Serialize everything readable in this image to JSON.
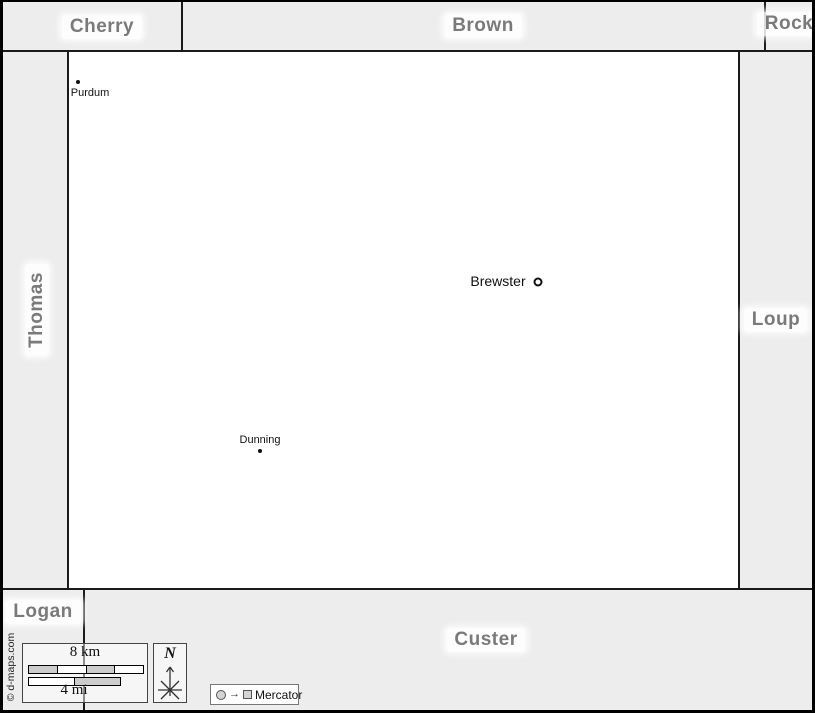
{
  "regions": {
    "cherry": "Cherry",
    "brown": "Brown",
    "rock": "Rock",
    "thomas": "Thomas",
    "loup": "Loup",
    "logan": "Logan",
    "custer": "Custer"
  },
  "towns": [
    {
      "name": "Purdum",
      "marker": "dot"
    },
    {
      "name": "Brewster",
      "marker": "county-seat-ring"
    },
    {
      "name": "Dunning",
      "marker": "dot"
    }
  ],
  "scale_bar": {
    "km": "8 km",
    "mi": "4 mi"
  },
  "compass": {
    "label": "N"
  },
  "projection_legend": {
    "label": "Mercator"
  },
  "credit": "© d-maps.com",
  "colors": {
    "margin": "#ededed",
    "map": "#ffffff",
    "boundary": "#1a1a1a",
    "region_label": "#7a7a7a",
    "scale_segment": "#cccccc"
  }
}
